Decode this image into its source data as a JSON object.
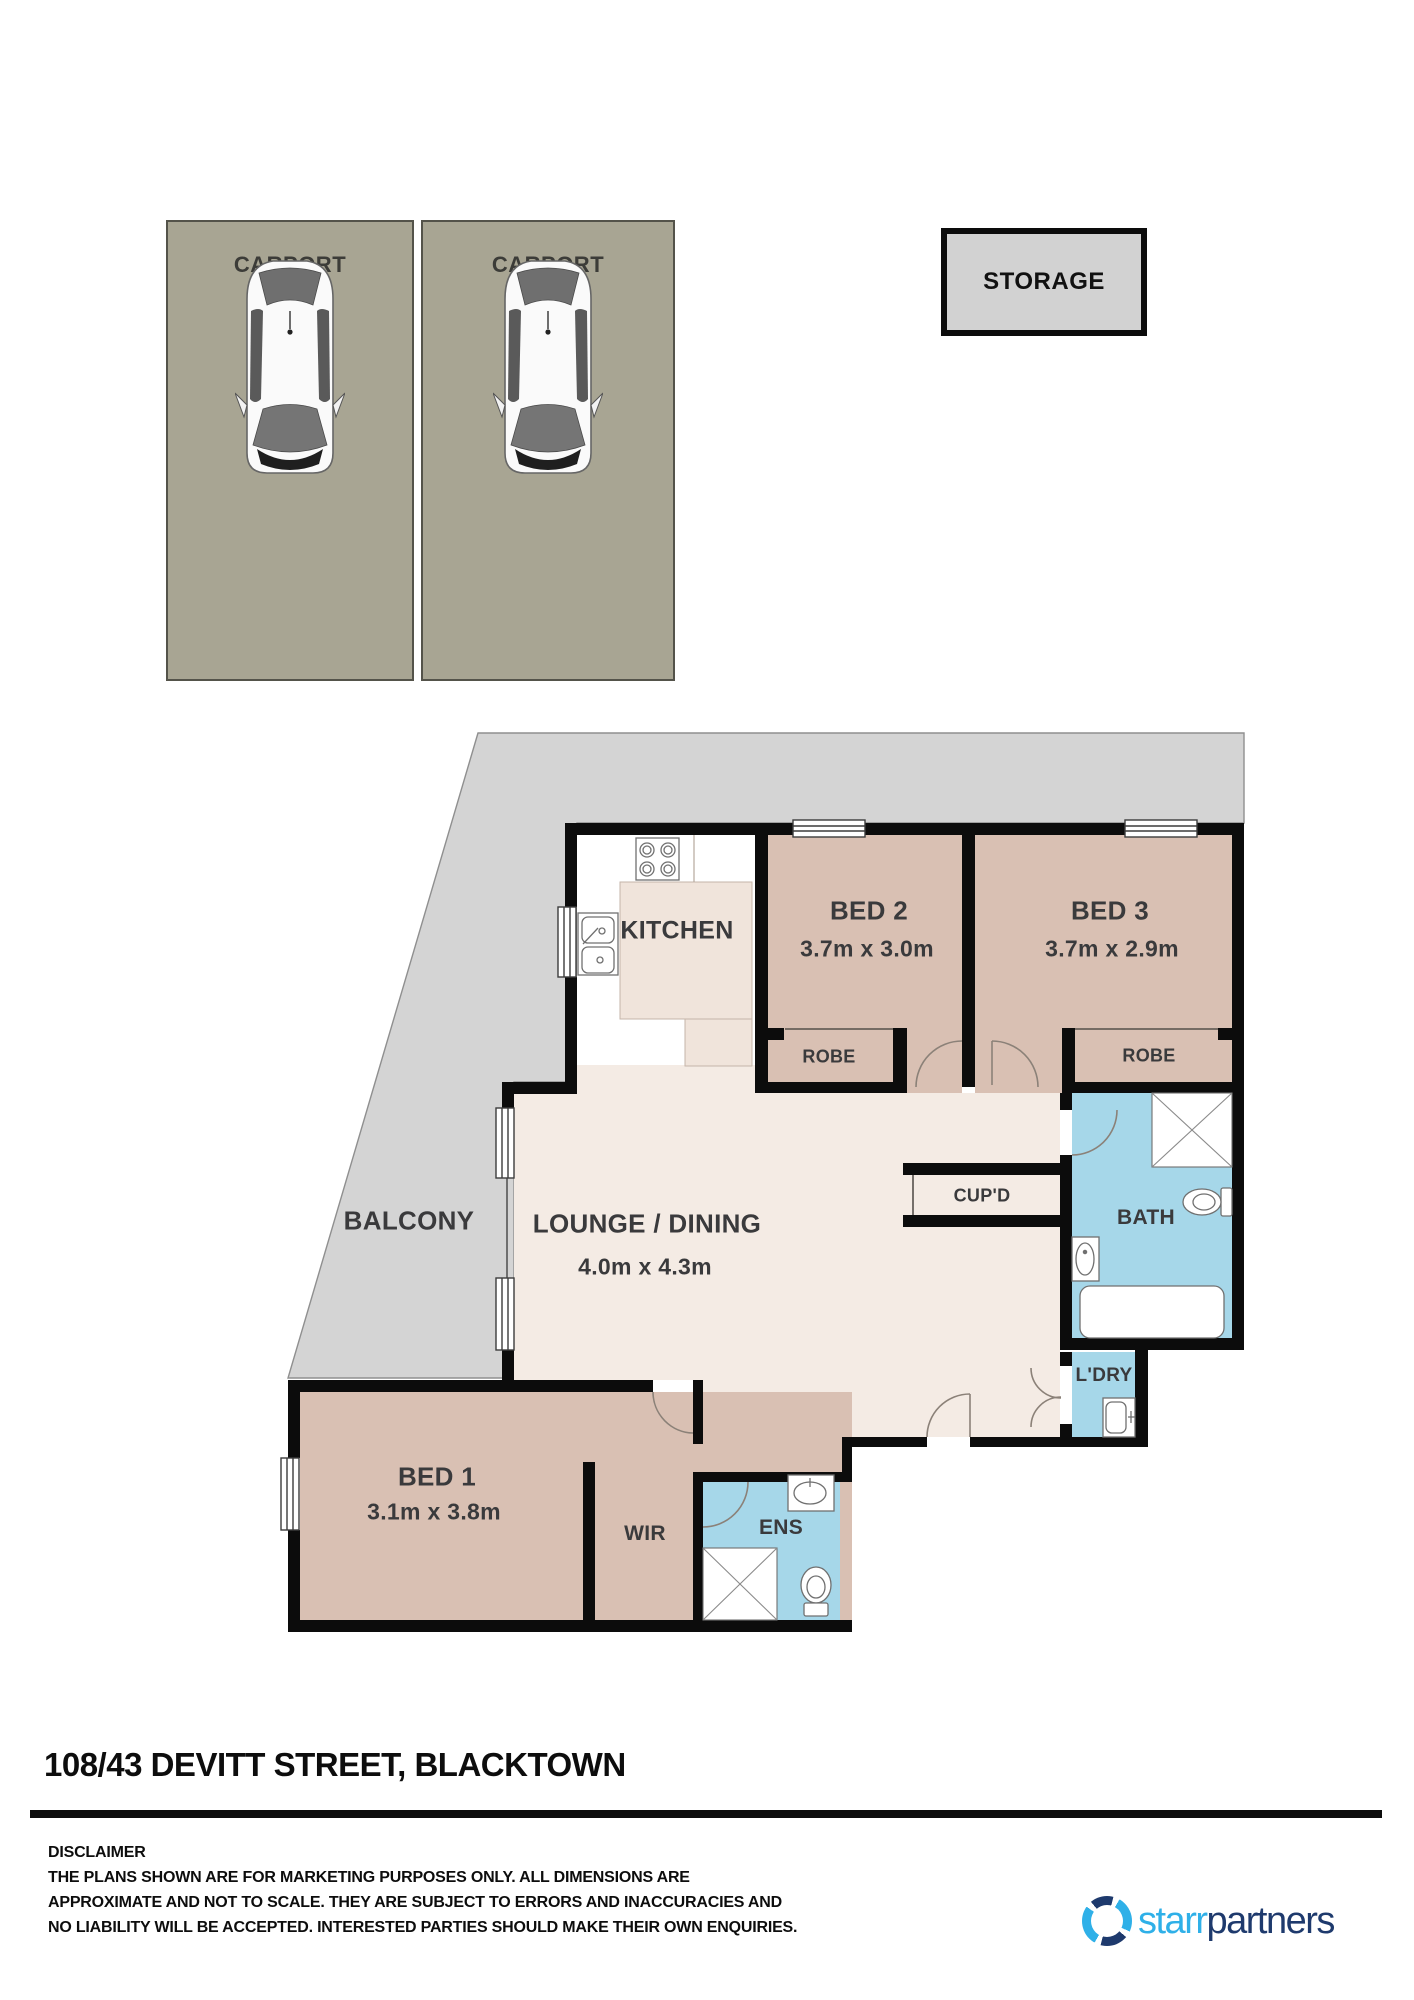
{
  "carports": {
    "carport1_label": "CARPORT",
    "carport2_label": "CARPORT"
  },
  "storage": {
    "label": "STORAGE"
  },
  "floorplan": {
    "balcony_label": "BALCONY",
    "kitchen_label": "KITCHEN",
    "bed2_label": "BED 2",
    "bed2_dims": "3.7m x 3.0m",
    "bed3_label": "BED 3",
    "bed3_dims": "3.7m x 2.9m",
    "robe2_label": "ROBE",
    "robe3_label": "ROBE",
    "lounge_label": "LOUNGE / DINING",
    "lounge_dims": "4.0m x 4.3m",
    "cupd_label": "CUP'D",
    "bath_label": "BATH",
    "ldry_label": "L'DRY",
    "bed1_label": "BED 1",
    "bed1_dims": "3.1m x 3.8m",
    "wir_label": "WIR",
    "ens_label": "ENS"
  },
  "address": {
    "title": "108/43 DEVITT STREET, BLACKTOWN"
  },
  "disclaimer": {
    "heading": "DISCLAIMER",
    "line1": "THE PLANS SHOWN ARE FOR MARKETING PURPOSES ONLY. ALL DIMENSIONS ARE",
    "line2": "APPROXIMATE AND NOT TO SCALE. THEY ARE SUBJECT TO ERRORS AND INACCURACIES AND",
    "line3": "NO LIABILITY WILL BE ACCEPTED. INTERESTED PARTIES SHOULD MAKE THEIR OWN ENQUIRIES."
  },
  "logo": {
    "brand_light": "starr",
    "brand_dark": "partners",
    "color_light": "#2fb0e8",
    "color_dark": "#1e3a6d"
  },
  "colors": {
    "wall": "#0c0c0c",
    "bedroom_floor": "#d9c0b3",
    "wet_area_floor": "#a6d7e9",
    "lounge_floor": "#f4ebe4",
    "balcony": "#d4d4d4",
    "carport": "#a8a593",
    "storage": "#d2d2d2",
    "counter": "#f0e4db"
  }
}
